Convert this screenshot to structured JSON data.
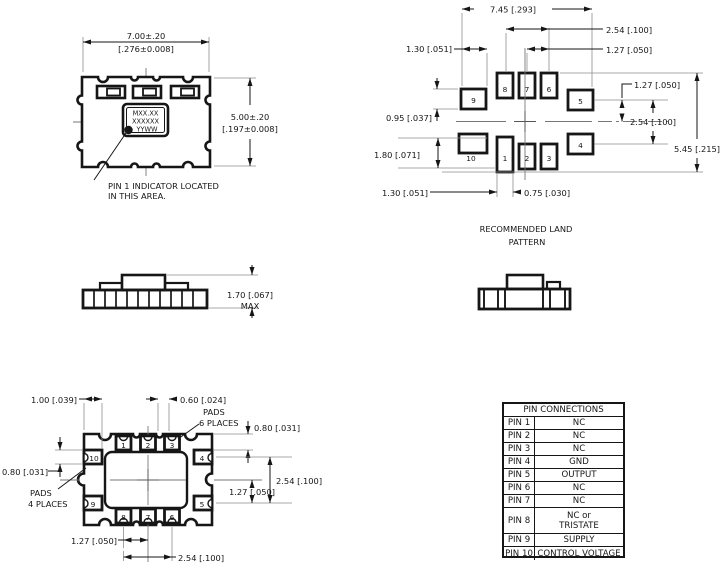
{
  "top_view": {
    "dim_width_mm": "7.00±.20",
    "dim_width_in": "[.276±0.008]",
    "dim_height_mm": "5.00±.20",
    "dim_height_in": "[.197±0.008]",
    "marking": {
      "line1": "MXX.XX",
      "line2": "XXXXXX",
      "line3": "YYWW"
    },
    "note_line1": "PIN 1 INDICATOR LOCATED",
    "note_line2": "IN THIS AREA."
  },
  "land_pattern": {
    "caption_line1": "RECOMMENDED LAND",
    "caption_line2": "PATTERN",
    "dim_overall_width": "7.45 [.293]",
    "dim_pitch_wide_top": "2.54 [.100]",
    "dim_pitch_narrow_top": "1.27 [.050]",
    "dim_pad_width_left": "1.30 [.051]",
    "dim_pad_height_left": "0.95 [.037]",
    "dim_pad1_height": "1.80 [.071]",
    "dim_bottom_left": "1.30 [.051]",
    "dim_pad1_width": "0.75 [.030]",
    "dim_pitch_narrow_right": "1.27 [.050]",
    "dim_pitch_wide_right": "2.54 [.100]",
    "dim_overall_height": "5.45 [.215]",
    "pads": {
      "p1": "1",
      "p2": "2",
      "p3": "3",
      "p4": "4",
      "p5": "5",
      "p6": "6",
      "p7": "7",
      "p8": "8",
      "p9": "9",
      "p10": "10"
    }
  },
  "side_view": {
    "dim_height": "1.70 [.067]",
    "dim_height_qualifier": "MAX"
  },
  "bottom_view": {
    "dim_edge_to_pad": "1.00 [.039]",
    "dim_pad_width_top": "0.60 [.024]",
    "pads6_line1": "PADS",
    "pads6_line2": "6 PLACES",
    "dim_pad_length_right": "0.80 [.031]",
    "dim_pad_length_left": "0.80 [.031]",
    "pads4_line1": "PADS",
    "pads4_line2": "4 PLACES",
    "dim_pitch_wide_right": "2.54 [.100]",
    "dim_pitch_narrow_right": "1.27 [.050]",
    "dim_pitch_narrow_bottom": "1.27 [.050]",
    "dim_pitch_wide_bottom": "2.54 [.100]",
    "pads": {
      "p1": "1",
      "p2": "2",
      "p3": "3",
      "p4": "4",
      "p5": "5",
      "p6": "6",
      "p7": "7",
      "p8": "8",
      "p9": "9",
      "p10": "10"
    }
  },
  "pin_table": {
    "title": "PIN CONNECTIONS",
    "rows": [
      {
        "pin": "PIN 1",
        "connection": "NC"
      },
      {
        "pin": "PIN 2",
        "connection": "NC"
      },
      {
        "pin": "PIN 3",
        "connection": "NC"
      },
      {
        "pin": "PIN 4",
        "connection": "GND"
      },
      {
        "pin": "PIN 5",
        "connection": "OUTPUT"
      },
      {
        "pin": "PIN 6",
        "connection": "NC"
      },
      {
        "pin": "PIN 7",
        "connection": "NC"
      },
      {
        "pin": "PIN 8",
        "connection": "NC or",
        "connection2": "TRISTATE"
      },
      {
        "pin": "PIN 9",
        "connection": "SUPPLY"
      },
      {
        "pin": "PIN 10",
        "connection": "CONTROL VOLTAGE"
      }
    ]
  },
  "colors": {
    "ink": "#161616",
    "auxiliary_lines": "#8d8d8d",
    "background": "#ffffff"
  }
}
